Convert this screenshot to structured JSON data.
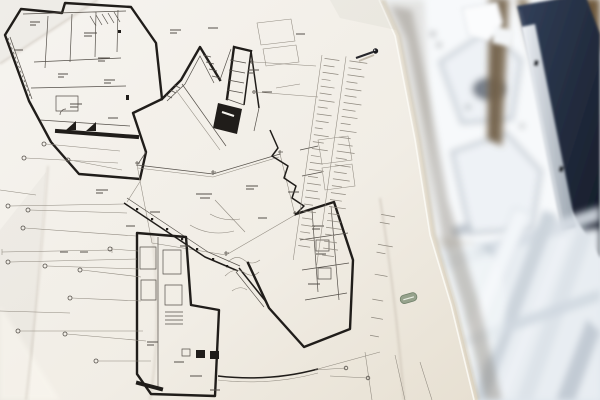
{
  "scene": {
    "description": "Photograph of a black-and-white architectural floor plan sheet pinned to a wall. The angular, star-shaped plan has a central five-sided courtyard, thick inked walls, dense illegible annotations, leader lines to small reference symbols, and a notes column on the right of the sheet. A dark push pin holds the top-right corner and a small green oval stamp sits near the right edge. Behind the sheet is an out-of-focus construction scene: a white panel, a dark navy window frame, wooden beams and bright metal scaffolding poles.",
    "objects": {
      "paper": "architectural floor-plan sheet (hand-annotated, text too small to read)",
      "floor_plan": "angular star-shaped building plan with pentagonal courtyard",
      "notes_column": "column of fine printed notes (illegible)",
      "push_pin": "dark metal push pin at top right of sheet",
      "stamp": "small green oval stamp near right paper edge",
      "background": "blurred construction scaffolding, white panel and navy window frame"
    },
    "legible_text": ""
  },
  "colors": {
    "ink": "#201d1a",
    "inkMid": "#55504a",
    "inkFaint": "#8f897f",
    "paper": "#f4f2ed",
    "paperEdge": "#cfc4ae",
    "wall": "#e4e4e2",
    "bgTop": "#f4f6f8",
    "bgBottom": "#dfe6ed",
    "navy": "#141a26",
    "navyLight": "#33415b",
    "wood": "#7b6950",
    "woodDark": "#6f5a3e",
    "rail": "#b9c0c9",
    "pole": "#ccd4dc",
    "poleBright": "#f3f6f9",
    "stamp": "#96a28c",
    "stampEdge": "#70806a",
    "pin": "#26262b",
    "shadow": "#6e6557"
  }
}
